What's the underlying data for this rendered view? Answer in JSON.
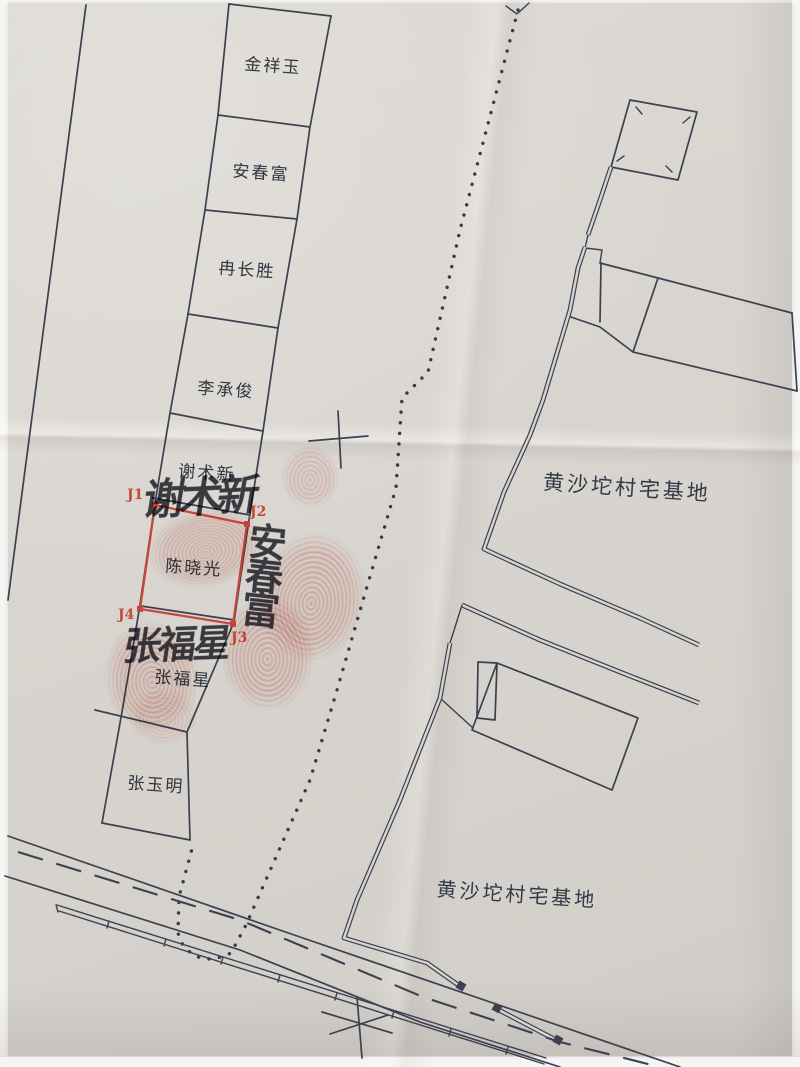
{
  "parcels": {
    "names": [
      "金祥玉",
      "安春富",
      "冉长胜",
      "李承俊",
      "谢术新",
      "陈晓光",
      "张福星",
      "张玉明"
    ]
  },
  "highlight_plot": {
    "owner": "陈晓光",
    "corner_labels": {
      "j1": "J1",
      "j2": "J2",
      "j3": "J3",
      "j4": "J4"
    },
    "boundary_color": "#c9473a"
  },
  "area_labels": {
    "upper": "黄沙坨村宅基地",
    "lower": "黄沙坨村宅基地"
  },
  "signatures": {
    "top": "谢术新",
    "right": "安春富",
    "bottom": "张福星"
  },
  "colors": {
    "paper": "#d8d4cf",
    "ink": "#3b4150",
    "red": "#c9473a",
    "fingerprint": "#d97666"
  }
}
